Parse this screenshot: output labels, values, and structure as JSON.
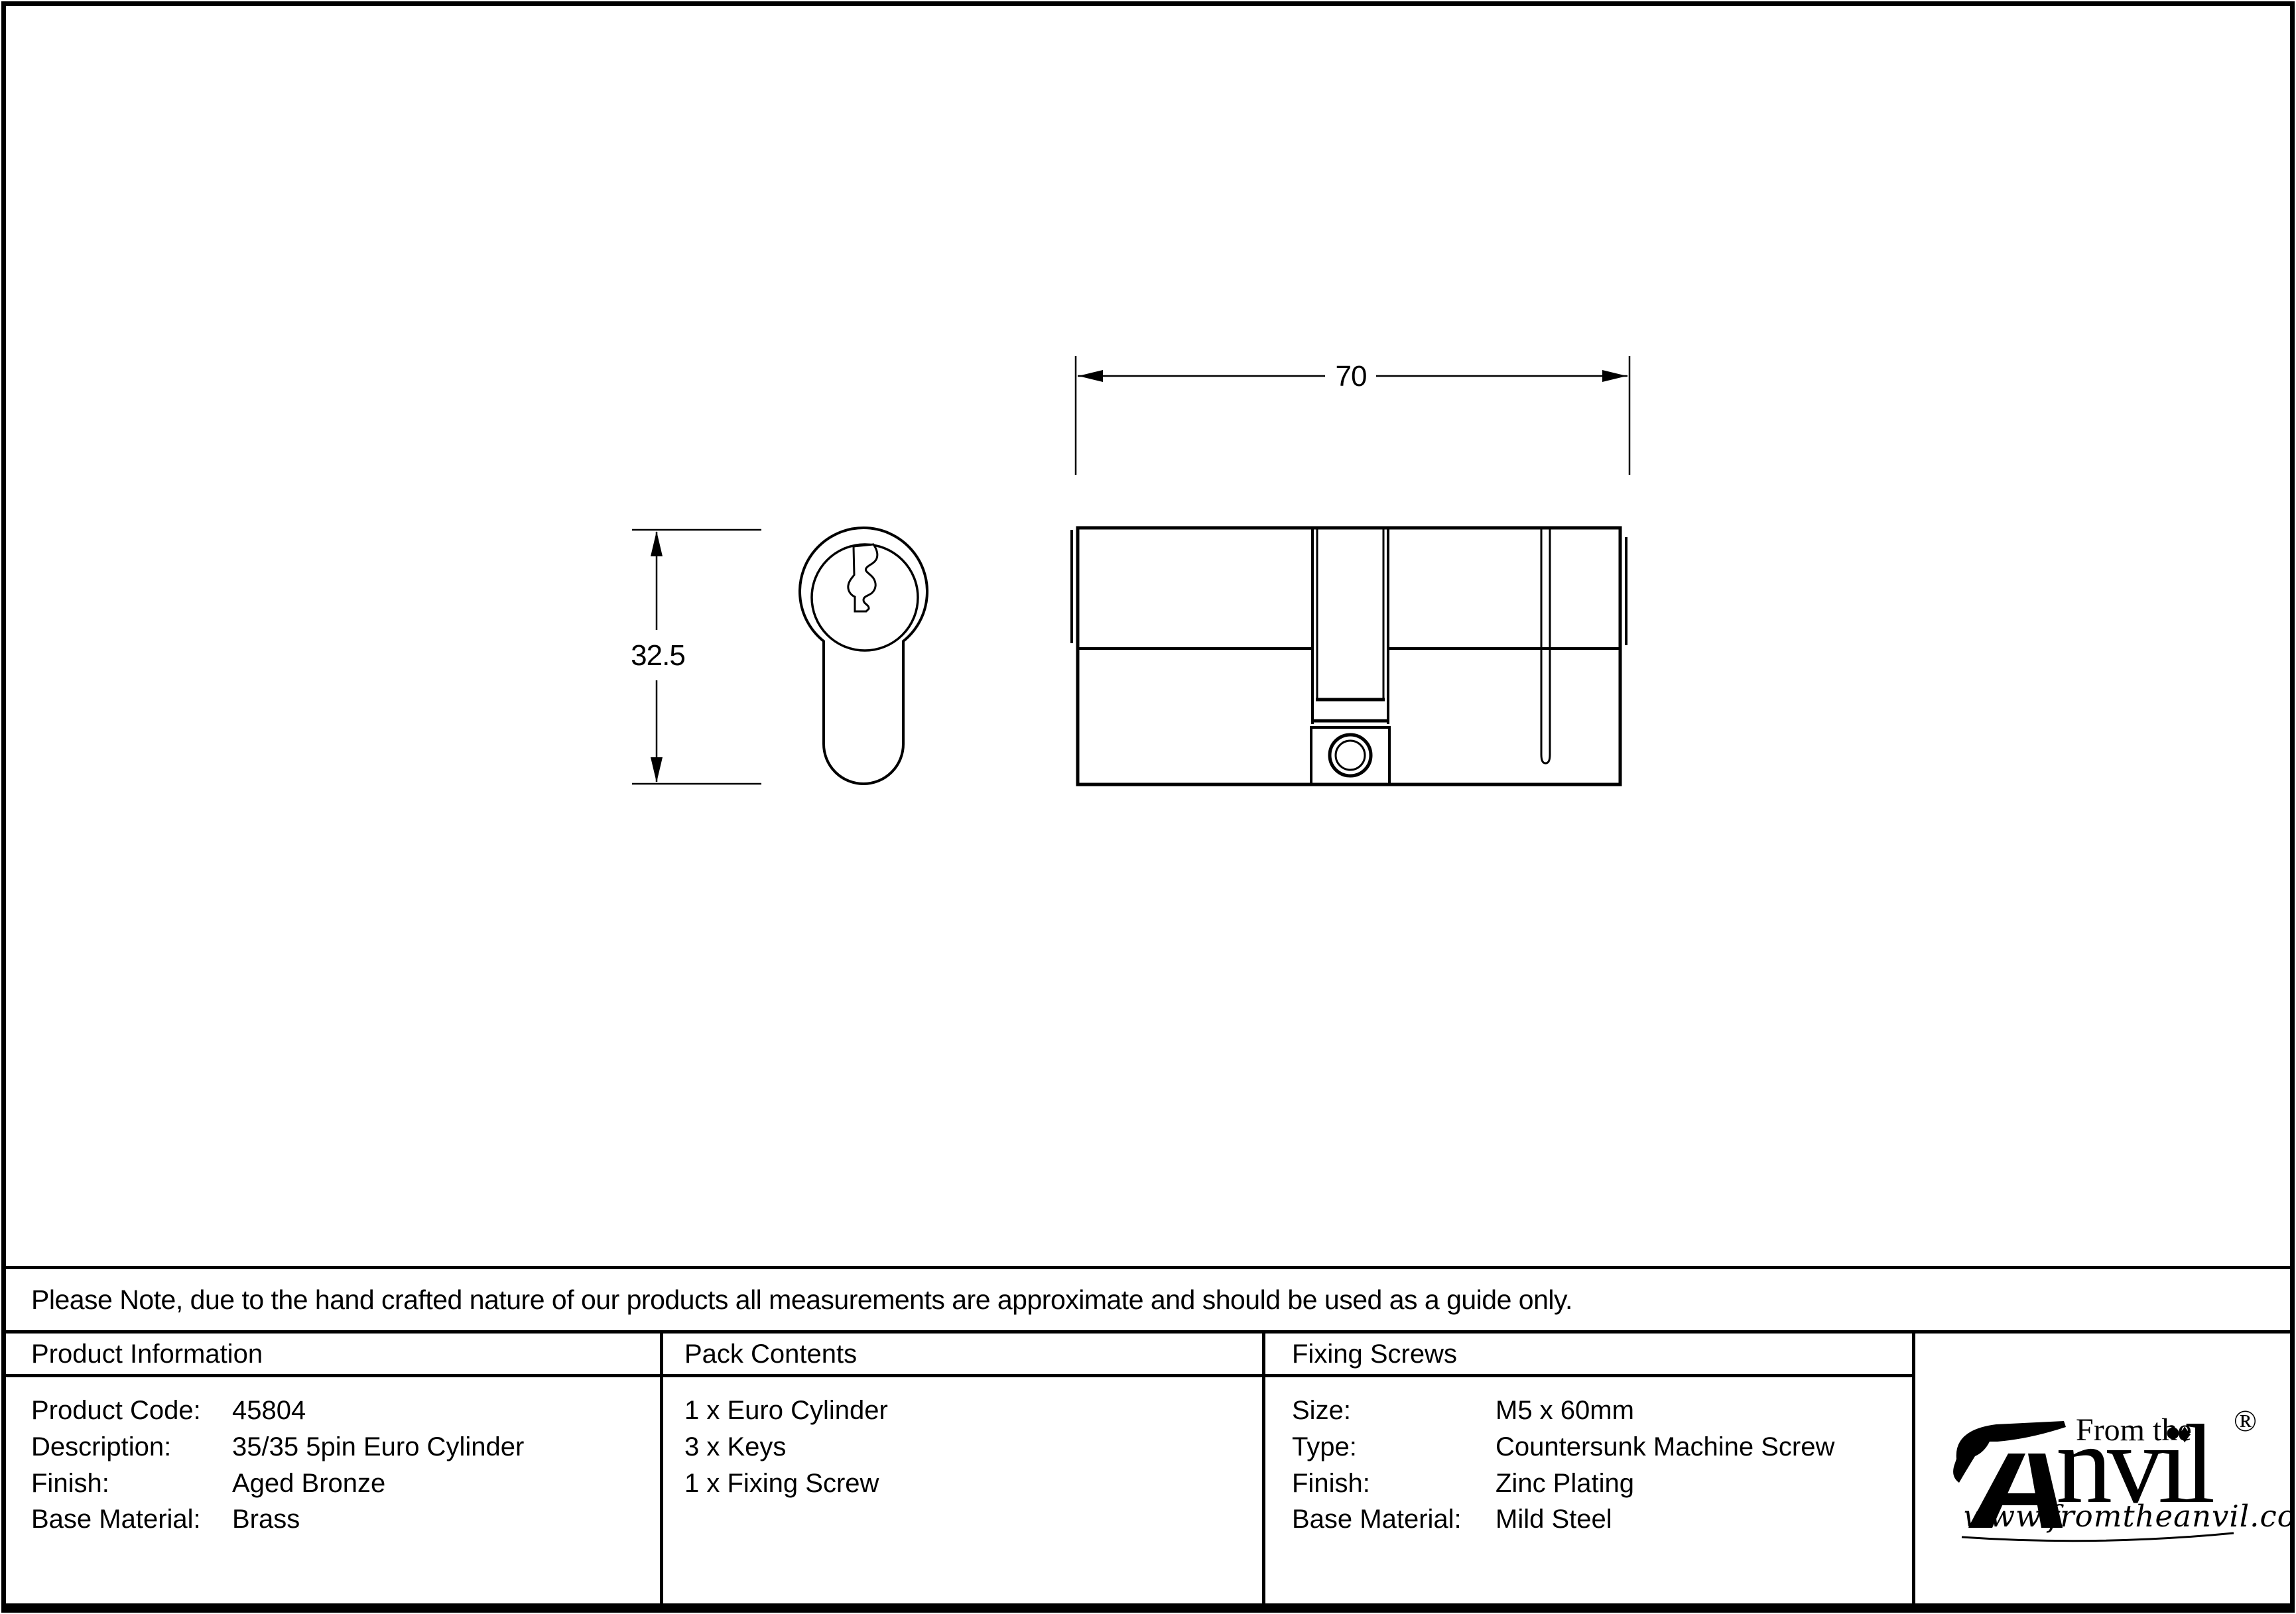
{
  "note": {
    "text": "Please Note, due to the hand crafted nature of our products all measurements are approximate and should be used as a guide only."
  },
  "drawing": {
    "width_dim": "70",
    "height_dim": "32.5"
  },
  "tables": {
    "product_information": {
      "header": "Product Information",
      "rows": [
        {
          "label": "Product Code:",
          "value": "45804"
        },
        {
          "label": "Description:",
          "value": "35/35 5pin Euro Cylinder"
        },
        {
          "label": "Finish:",
          "value": "Aged Bronze"
        },
        {
          "label": "Base Material:",
          "value": "Brass"
        }
      ]
    },
    "pack_contents": {
      "header": "Pack Contents",
      "items": [
        "1 x Euro Cylinder",
        "3 x Keys",
        "1 x Fixing Screw"
      ]
    },
    "fixing_screws": {
      "header": "Fixing Screws",
      "rows": [
        {
          "label": "Size:",
          "value": "M5 x 60mm"
        },
        {
          "label": "Type:",
          "value": "Countersunk Machine Screw"
        },
        {
          "label": "Finish:",
          "value": "Zinc Plating"
        },
        {
          "label": "Base Material:",
          "value": "Mild Steel"
        }
      ]
    }
  },
  "logo": {
    "prefix": "From the",
    "name_rest": "nvil",
    "registered": "®",
    "diamond": "♦",
    "url": "www.fromtheanvil.co.uk"
  },
  "colors": {
    "ink": "#000000",
    "paper": "#ffffff"
  }
}
